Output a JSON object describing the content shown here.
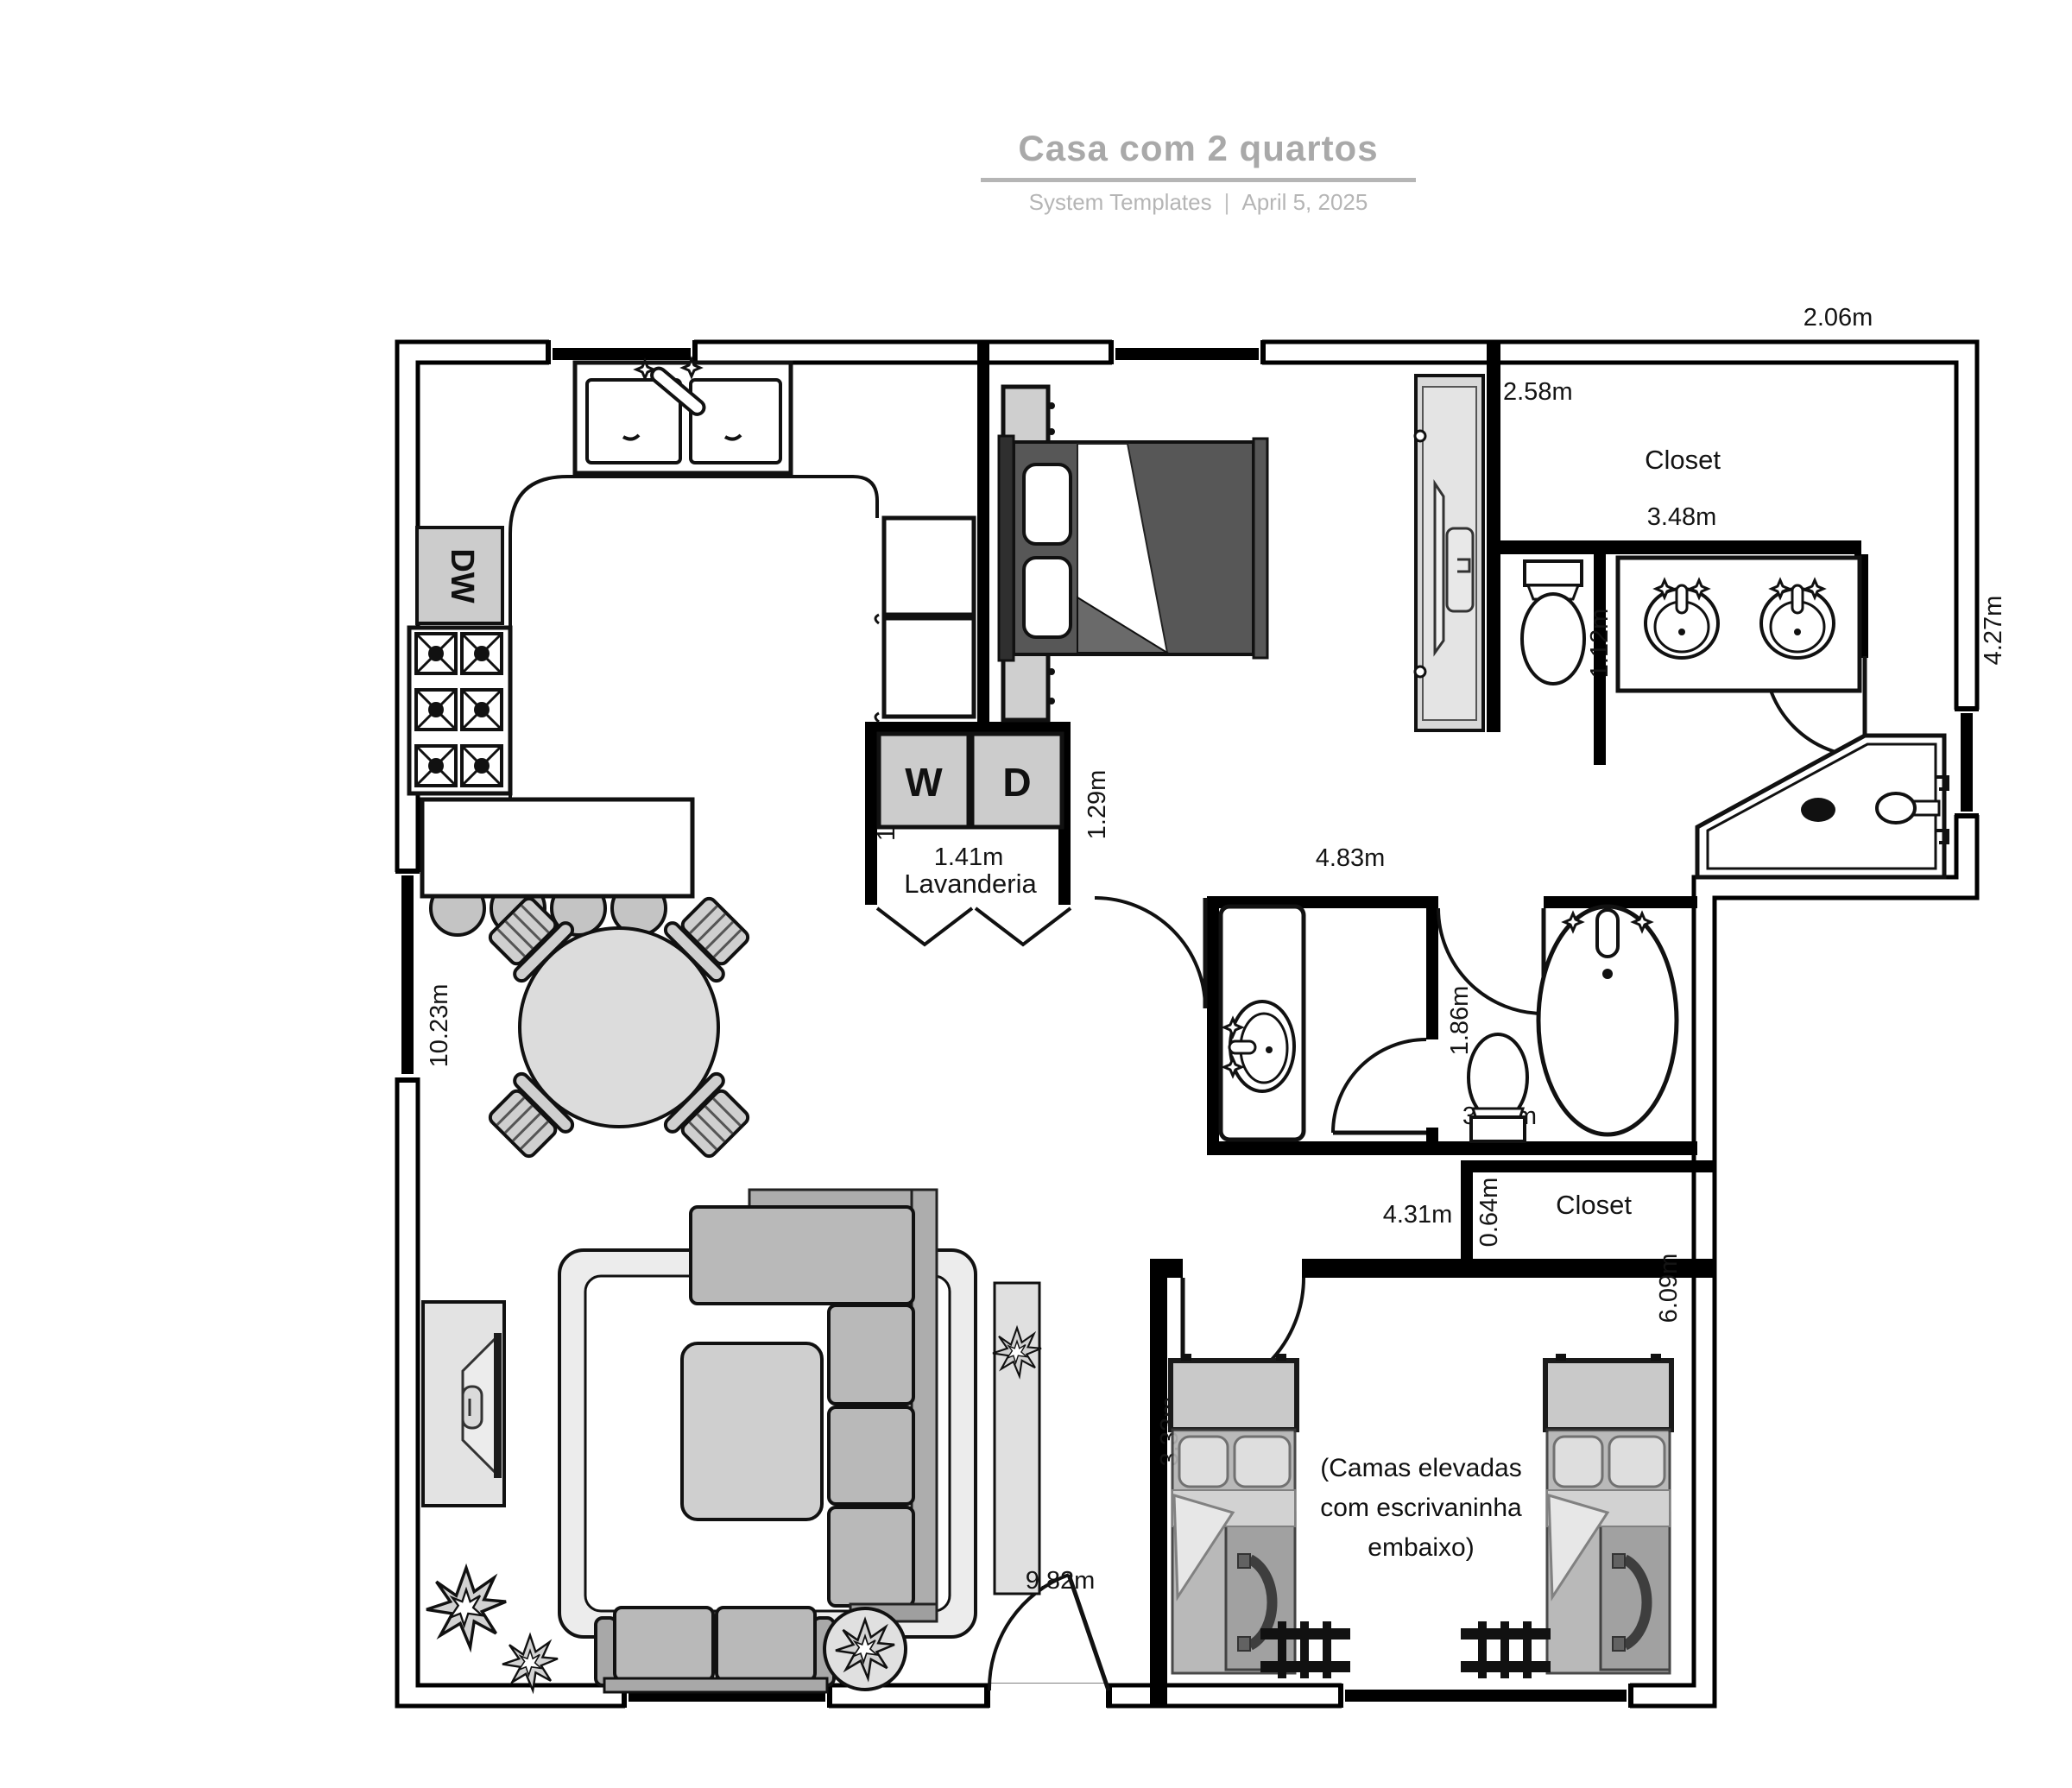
{
  "header": {
    "title": "Casa com 2 quartos",
    "byline": "System Templates",
    "separator": "|",
    "date": "April 5, 2025"
  },
  "labels": {
    "top_right_width": "2.06m",
    "right_height": "4.27m",
    "closet1_depth": "2.58m",
    "closet1_name": "Closet",
    "closet1_width": "3.48m",
    "bed1_width": "1.69m",
    "vanity1_width": "1.12m",
    "toilet1_partial": "4",
    "hall_width": "4.83m",
    "hall_gap": "1.29m",
    "laundry_partial": "1",
    "laundry_width": "1.41m",
    "laundry_name": "Lavanderia",
    "washer": "W",
    "dryer": "D",
    "dishwasher": "DW",
    "living_height": "10.23m",
    "bath2_width": "1.86m",
    "toilet2_partial_left": "3",
    "toilet2_partial_right": "m",
    "closet2_gap": "0.64m",
    "closet2_name": "Closet",
    "passage_width": "4.31m",
    "bedroom2_height": "6.09m",
    "bedroom2_bed_height": "3.33m",
    "bottom_width": "9.82m",
    "bedroom2_note_1": "(Camas elevadas",
    "bedroom2_note_2": "com escrivaninha",
    "bedroom2_note_3": "embaixo)"
  },
  "colors": {
    "wall": "#000000",
    "furniture_gray": "#b9b9b9",
    "light_gray": "#d6d6d6",
    "bed_dark": "#575757",
    "title_gray": "#a9a9a9"
  }
}
